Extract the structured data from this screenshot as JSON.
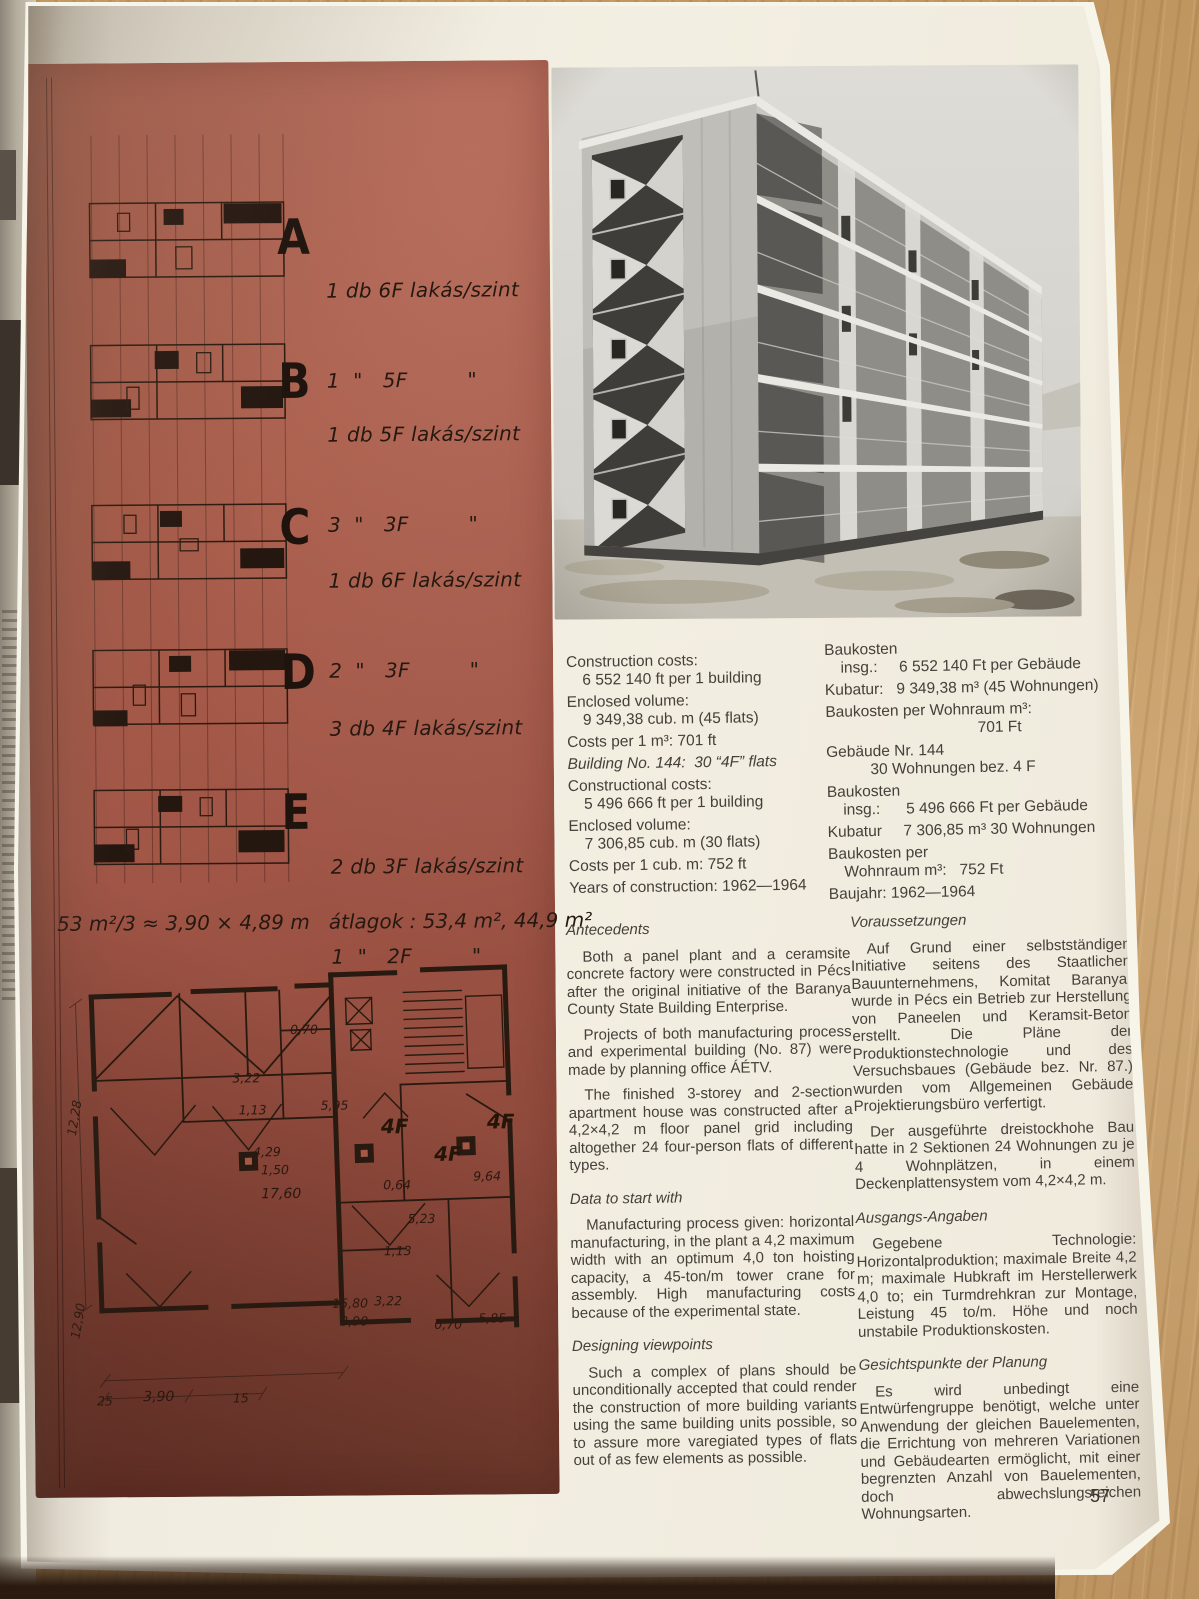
{
  "page": {
    "number": "57"
  },
  "red_panel": {
    "types": [
      {
        "letter": "A",
        "line1": "1 db 6F lakás/szint",
        "line2": "1  \"   5F         \""
      },
      {
        "letter": "B",
        "line1": "1 db 5F lakás/szint",
        "line2": "3  \"   3F         \""
      },
      {
        "letter": "C",
        "line1": "1 db 6F lakás/szint",
        "line2": "2  \"   3F         \""
      },
      {
        "letter": "D",
        "line1": "3 db 4F lakás/szint",
        "line2": ""
      },
      {
        "letter": "E",
        "line1": "2 db 3F lakás/szint",
        "line2": "1  \"   2F         \""
      }
    ],
    "formula": "53 m²/3 ≈ 3,90 × 4,89 m   átlagok : 53,4 m², 44,9 m²",
    "plan": {
      "units": [
        "4F",
        "4F",
        "4F"
      ],
      "dims": {
        "d070a": "0,70",
        "d322a": "3,22",
        "d113a": "1,13",
        "d595": "5,95",
        "d429": "4,29",
        "d150": "1,50",
        "d1760": "17,60",
        "d064": "0,64",
        "d964": "9,64",
        "d523": "5,23",
        "d113b": "1,13",
        "d322b": "3,22",
        "d1580": "15,80",
        "d390a": "3,90",
        "d070b": "0,70",
        "d585": "5,85",
        "d1228": "12,28",
        "d1290": "12,90",
        "d25": "25",
        "d390b": "3,90",
        "d15": "15"
      }
    }
  },
  "stats_en": {
    "lines": [
      "Construction costs:",
      "6 552 140 ft per 1 building",
      "Enclosed volume:",
      "9 349,38 cub. m (45 flats)",
      "Costs per 1 m³: 701 ft",
      "Building No. 144:  30 “4F” flats",
      "Constructional costs:",
      "5 496 666 ft per 1 building",
      "Enclosed volume:",
      "7 306,85 cub. m (30 flats)",
      "Costs per 1 cub. m: 752 ft",
      "Years of construction: 1962—1964"
    ]
  },
  "stats_de": {
    "lines": [
      "Baukosten",
      "insg.:     6 552 140 Ft per Gebäude",
      "Kubatur:   9 349,38 m³ (45 Wohnungen)",
      "Baukosten per Wohnraum m³:",
      "701 Ft",
      "Gebäude Nr. 144",
      "30 Wohnungen bez. 4 F",
      "Baukosten",
      "insg.:      5 496 666 Ft per Gebäude",
      "Kubatur     7 306,85 m³ 30 Wohnungen",
      "Baukosten per",
      "Wohnraum m³:   752 Ft",
      "Baujahr: 1962—1964"
    ]
  },
  "sections_en": [
    {
      "heading": "Antecedents",
      "paras": [
        "Both a panel plant and a ceramsite concrete factory were constructed in Pécs after the original initiative of the Baranya County State Building Enterprise.",
        "Projects of both manufacturing process and experimental building (No. 87) were made by planning office ÁÉTV.",
        "The finished 3-storey and 2-section apartment house was constructed after a 4,2×4,2 m floor panel grid including altogether 24 four-person flats of different types."
      ]
    },
    {
      "heading": "Data to start with",
      "paras": [
        "Manufacturing process given: horizontal manufacturing, in the plant a 4,2 maximum width with an optimum 4,0 ton hoisting capacity, a 45-ton/m tower crane for assembly. High manufacturing costs because of the experimental state."
      ]
    },
    {
      "heading": "Designing viewpoints",
      "paras": [
        "Such a complex of plans should be unconditionally accepted that could render the construction of more building variants using the same building units possible, so to assure more varegiated types of flats out of as few elements as possible."
      ]
    }
  ],
  "sections_de": [
    {
      "heading": "Voraussetzungen",
      "paras": [
        "Auf Grund einer selbstständigen Initiative seitens des Staatlichen Bauunternehmens, Komitat Baranya, wurde in Pécs ein Betrieb zur Herstellung von Paneelen und Keramsit-Beton erstellt. Die Pläne der Produktionstechnologie und des Versuchsbaues (Gebäude bez. Nr. 87.) wurden vom Allgemeinen Gebäude Projektierungsbüro verfertigt.",
        "Der ausgeführte dreistockhohe Bau hatte in 2 Sektionen 24 Wohnungen zu je 4 Wohnplätzen, in einem Deckenplattensystem vom 4,2×4,2 m."
      ]
    },
    {
      "heading": "Ausgangs-Angaben",
      "paras": [
        "Gegebene Technologie: Horizontalproduktion; maximale Breite 4,2 m; maximale Hubkraft im Herstellerwerk 4,0 to; ein Turmdrehkran zur Montage, Leistung 45 to/m. Höhe und noch unstabile Produktionskosten."
      ]
    },
    {
      "heading": "Gesichtspunkte der Planung",
      "paras": [
        "Es wird unbedingt eine Entwürfengruppe benötigt, welche unter Anwendung der gleichen Bauelementen, die Errichtung von mehreren Variationen und Gebäudearten ermöglicht, mit einer begrenzten Anzahl von Bauelementen, doch abwechslungsreichen Wohnungsarten."
      ]
    }
  ],
  "colors": {
    "panel_red": "#a65847",
    "page_cream": "#eeeadd",
    "wood": "#c2996b",
    "ink": "#44403a"
  }
}
